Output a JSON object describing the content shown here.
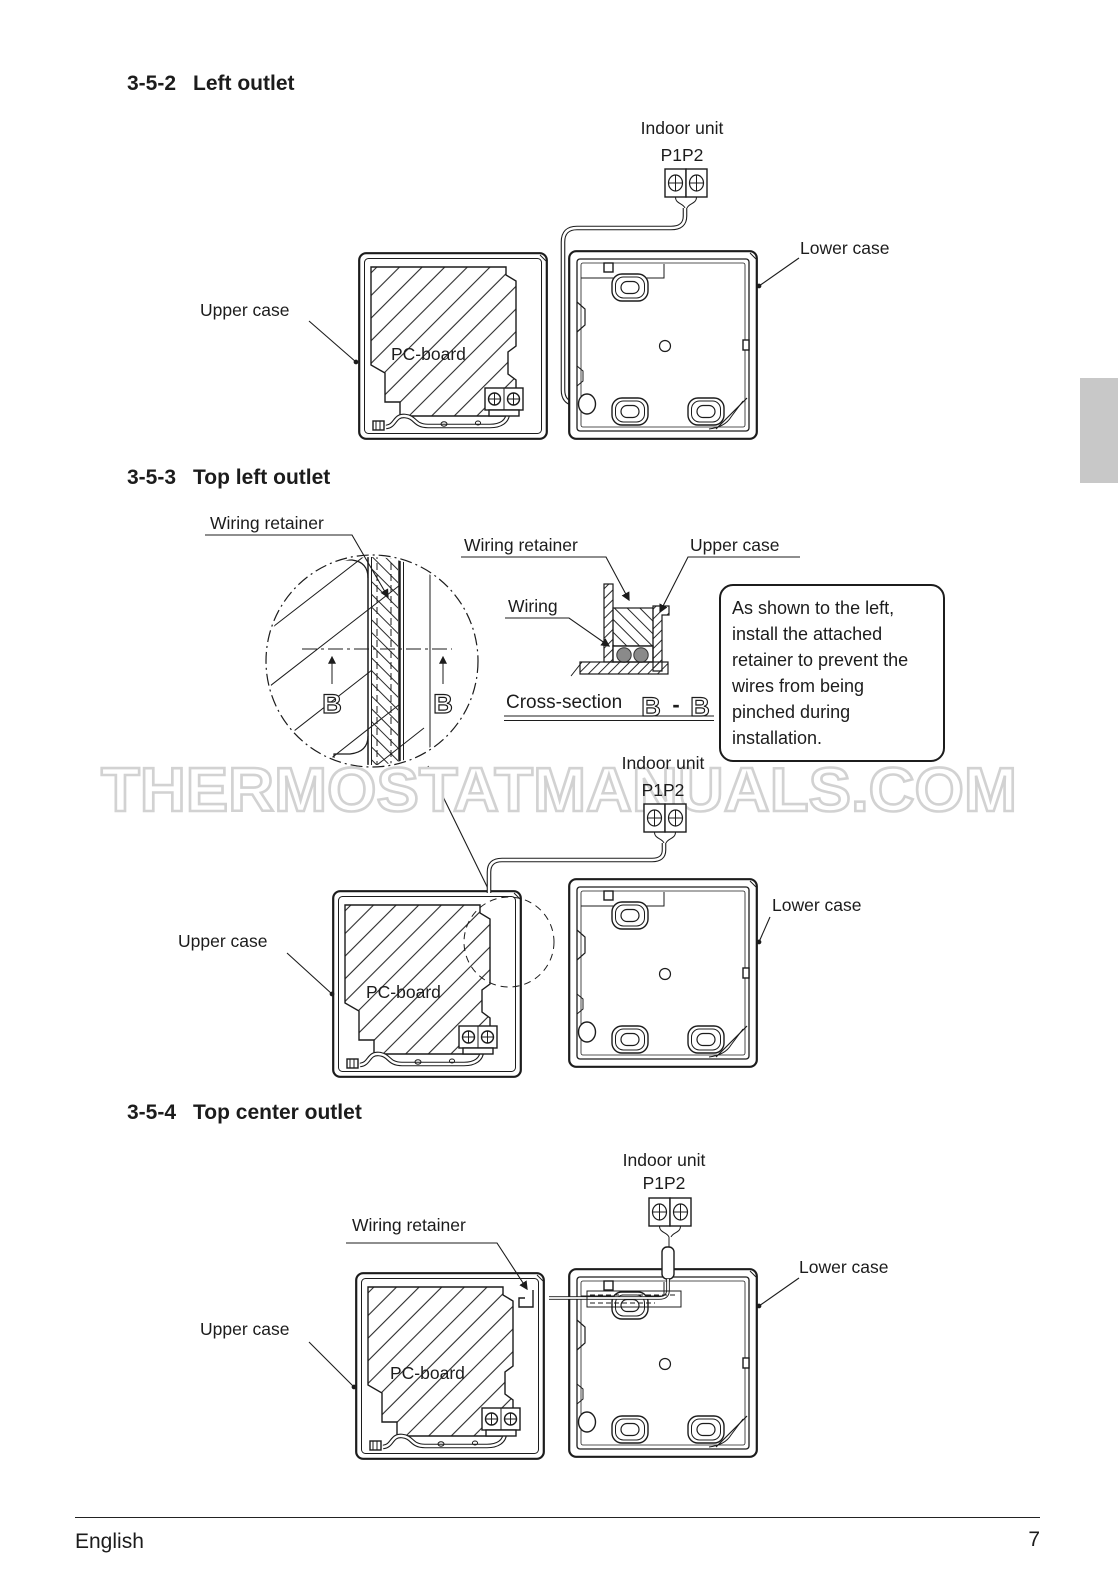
{
  "watermark": "THERMOSTATMANUALS.COM",
  "footer": {
    "language": "English",
    "page_number": "7"
  },
  "colors": {
    "line": "#1c1c1c",
    "watermark_outline": "#d2d2d2",
    "wire_fill": "#8a8a8a",
    "side_tab": "#c8c8c8"
  },
  "sections": {
    "s1": {
      "number": "3-5-2",
      "title": "Left outlet",
      "indoor_unit": "Indoor unit",
      "terminals": "P1P2",
      "upper_case": "Upper case",
      "lower_case": "Lower case",
      "pc_board": "PC-board"
    },
    "s2": {
      "number": "3-5-3",
      "title": "Top left outlet",
      "wiring_retainer_detail": "Wiring retainer",
      "wiring_retainer_section": "Wiring retainer",
      "upper_case_section": "Upper case",
      "wiring": "Wiring",
      "cross_section_label": "Cross-section",
      "section_mark_left": "B",
      "section_mark_separator": "-",
      "section_mark_right": "B",
      "detail_mark_left": "B",
      "detail_mark_right": "B",
      "note": "As shown to the left, install the attached retainer to prevent the wires from being pinched during installation.",
      "indoor_unit": "Indoor unit",
      "terminals": "P1P2",
      "upper_case": "Upper case",
      "lower_case": "Lower case",
      "pc_board": "PC-board"
    },
    "s3": {
      "number": "3-5-4",
      "title": "Top center outlet",
      "wiring_retainer": "Wiring retainer",
      "indoor_unit": "Indoor unit",
      "terminals": "P1P2",
      "upper_case": "Upper case",
      "lower_case": "Lower case",
      "pc_board": "PC-board"
    }
  }
}
